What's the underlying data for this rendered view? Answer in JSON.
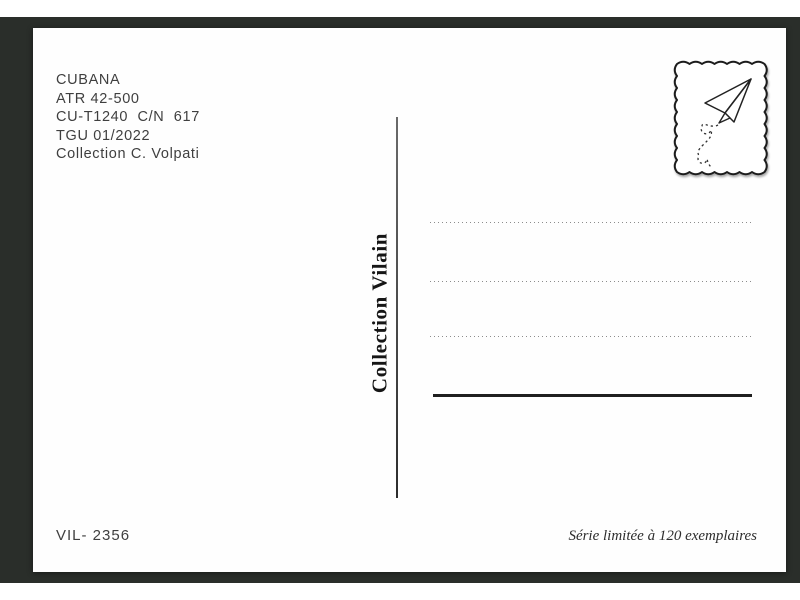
{
  "colors": {
    "frame_background": "#2a2e2a",
    "card_background": "#fefefe",
    "info_ink": "#3f3f3f",
    "print_ink": "#161616",
    "dotted_line": "#8c8c8c"
  },
  "postcard": {
    "info_block": {
      "lines": [
        "CUBANA",
        "ATR 42-500",
        "CU-T1240  C/N  617",
        "TGU 01/2022",
        "Collection C. Volpati"
      ]
    },
    "stamp": {
      "icon": "paper-plane-icon"
    },
    "spine_text": "Collection Vilain",
    "address_area": {
      "dotted_lines": 3,
      "solid_lines": 1
    },
    "catalog_number": "VIL- 2356",
    "edition_note": "Série limitée à 120 exemplaires"
  }
}
